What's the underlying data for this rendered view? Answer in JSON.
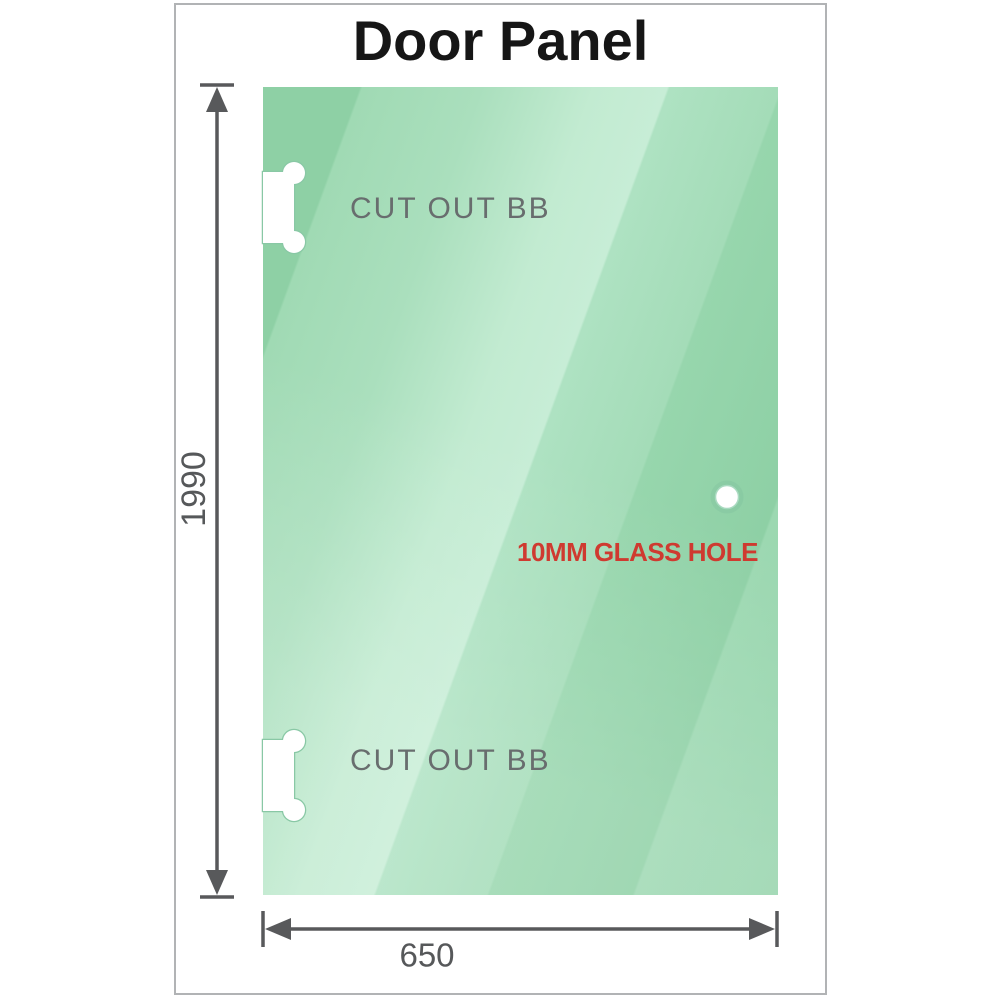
{
  "title": {
    "text": "Door Panel",
    "color": "#161616"
  },
  "panel": {
    "description": "glass door panel",
    "glass_base_color": "#9bd7b1",
    "glass_highlight_color": "#c7edd6",
    "cutouts": [
      {
        "label": "CUT OUT BB"
      },
      {
        "label": "CUT OUT BB"
      }
    ],
    "hole": {
      "label": "10MM GLASS HOLE",
      "label_color": "#cf3a30"
    }
  },
  "dimensions": {
    "height_mm": "1990",
    "width_mm": "650",
    "line_color": "#58595b"
  },
  "frame": {
    "border_color": "#b1b3b5"
  }
}
